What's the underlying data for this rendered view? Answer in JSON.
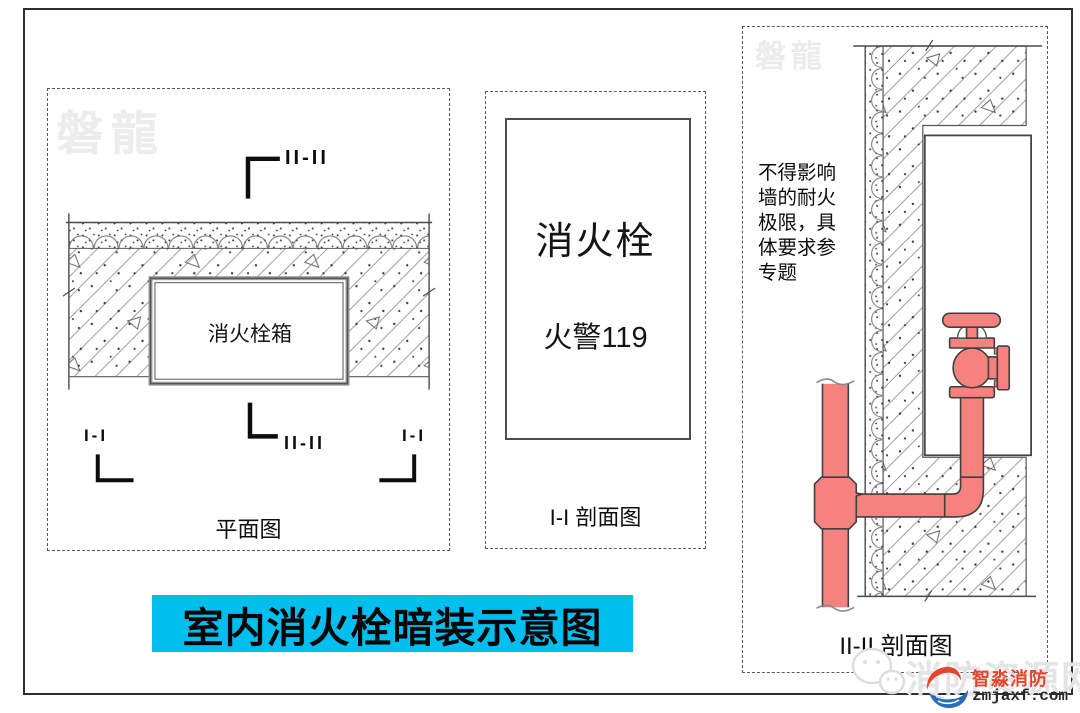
{
  "title_bar": {
    "text": "室内消火栓暗装示意图"
  },
  "plan_panel": {
    "watermark": "磐龍",
    "section_marker_top": "II-II",
    "box_label": "消火栓箱",
    "marker_left": "I-I",
    "marker_center": "II-II",
    "marker_right": "I-I",
    "caption": "平面图"
  },
  "section1_panel": {
    "cabinet_line1": "消火栓",
    "cabinet_line2": "火警119",
    "caption": "I-I 剖面图"
  },
  "section2_panel": {
    "watermark": "磐龍",
    "note_lines": [
      "不得影响",
      "墙的耐火",
      "极限，具",
      "体要求参",
      "专题"
    ],
    "caption": "II-II 剖面图"
  },
  "footer": {
    "watermark_site": "消防资源网",
    "logo_name": "智淼消防",
    "logo_url": "zmjaxf.com"
  },
  "colors": {
    "title_bg": "#00BFEF",
    "pipe_fill": "#F5827E",
    "watermark": "#ECECEC"
  }
}
